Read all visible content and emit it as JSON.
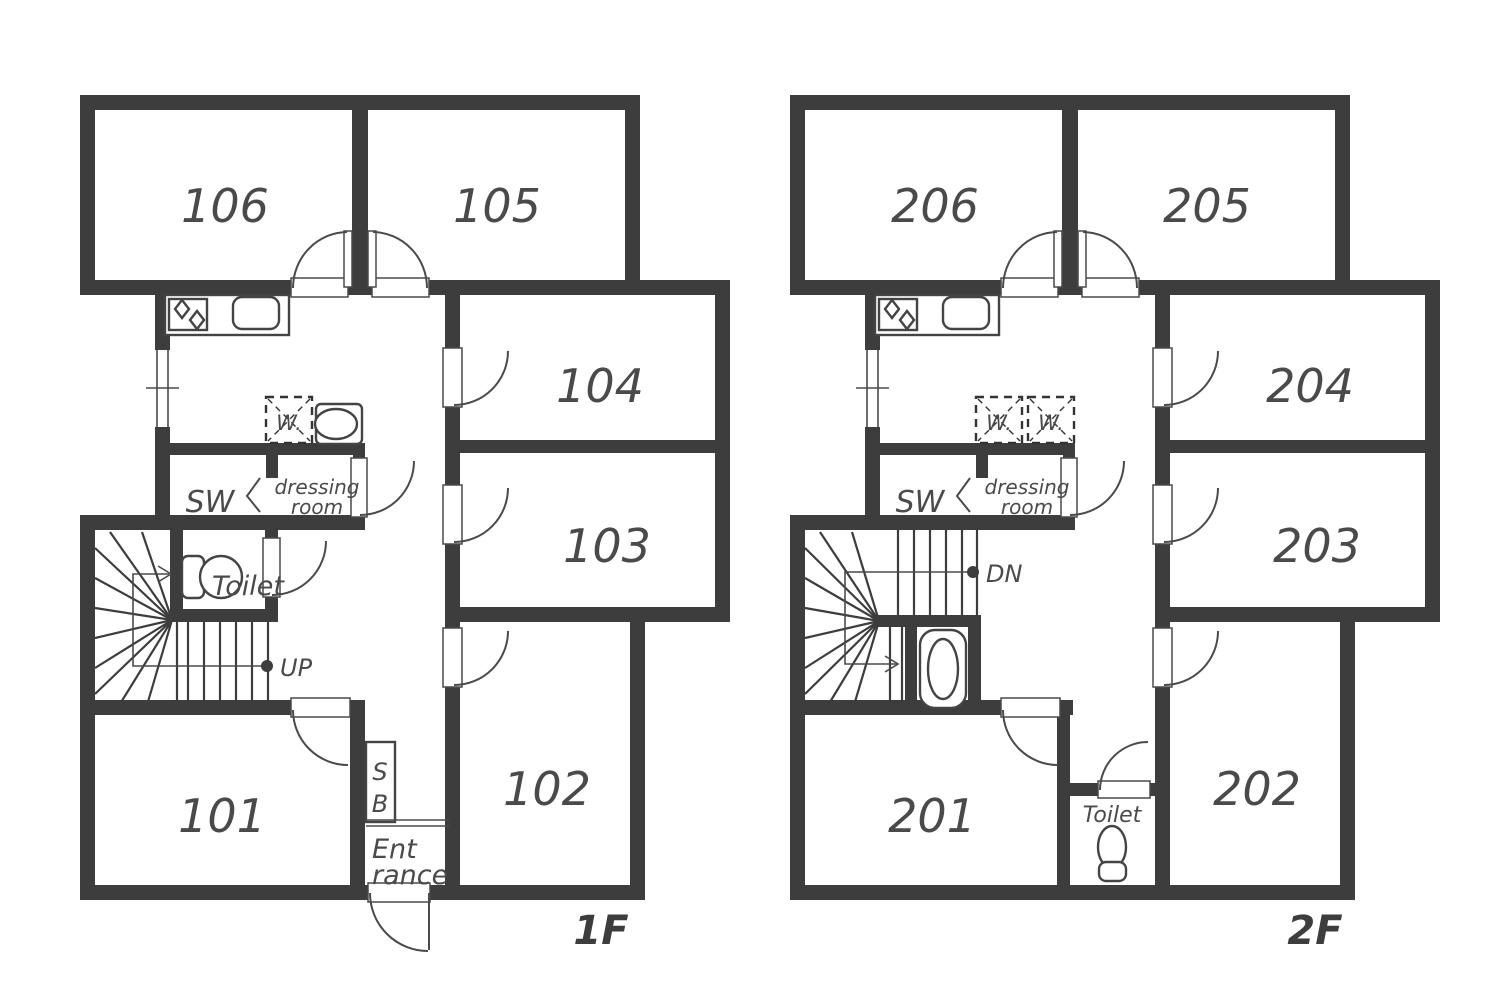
{
  "diagram": {
    "type": "floor-plan",
    "colors": {
      "wall": "#3d3d3d",
      "line": "#4a4a4a",
      "background": "#ffffff"
    },
    "floor1": {
      "floor_label": "1F",
      "room_106": "106",
      "room_105": "105",
      "room_104": "104",
      "room_103": "103",
      "room_102": "102",
      "room_101": "101",
      "sw_label": "SW",
      "dressing_line1": "dressing",
      "dressing_line2": "room",
      "toilet_label": "Toilet",
      "washer_label": "W.",
      "shoebox_line1": "S",
      "shoebox_line2": "B",
      "entrance_line1": "Ent",
      "entrance_line2": "rance",
      "stairs_label": "UP"
    },
    "floor2": {
      "floor_label": "2F",
      "room_206": "206",
      "room_205": "205",
      "room_204": "204",
      "room_203": "203",
      "room_202": "202",
      "room_201": "201",
      "sw_label": "SW",
      "dressing_line1": "dressing",
      "dressing_line2": "room",
      "toilet_label": "Toilet",
      "washer1_label": "W.",
      "washer2_label": "W.",
      "stairs_label": "DN"
    }
  }
}
